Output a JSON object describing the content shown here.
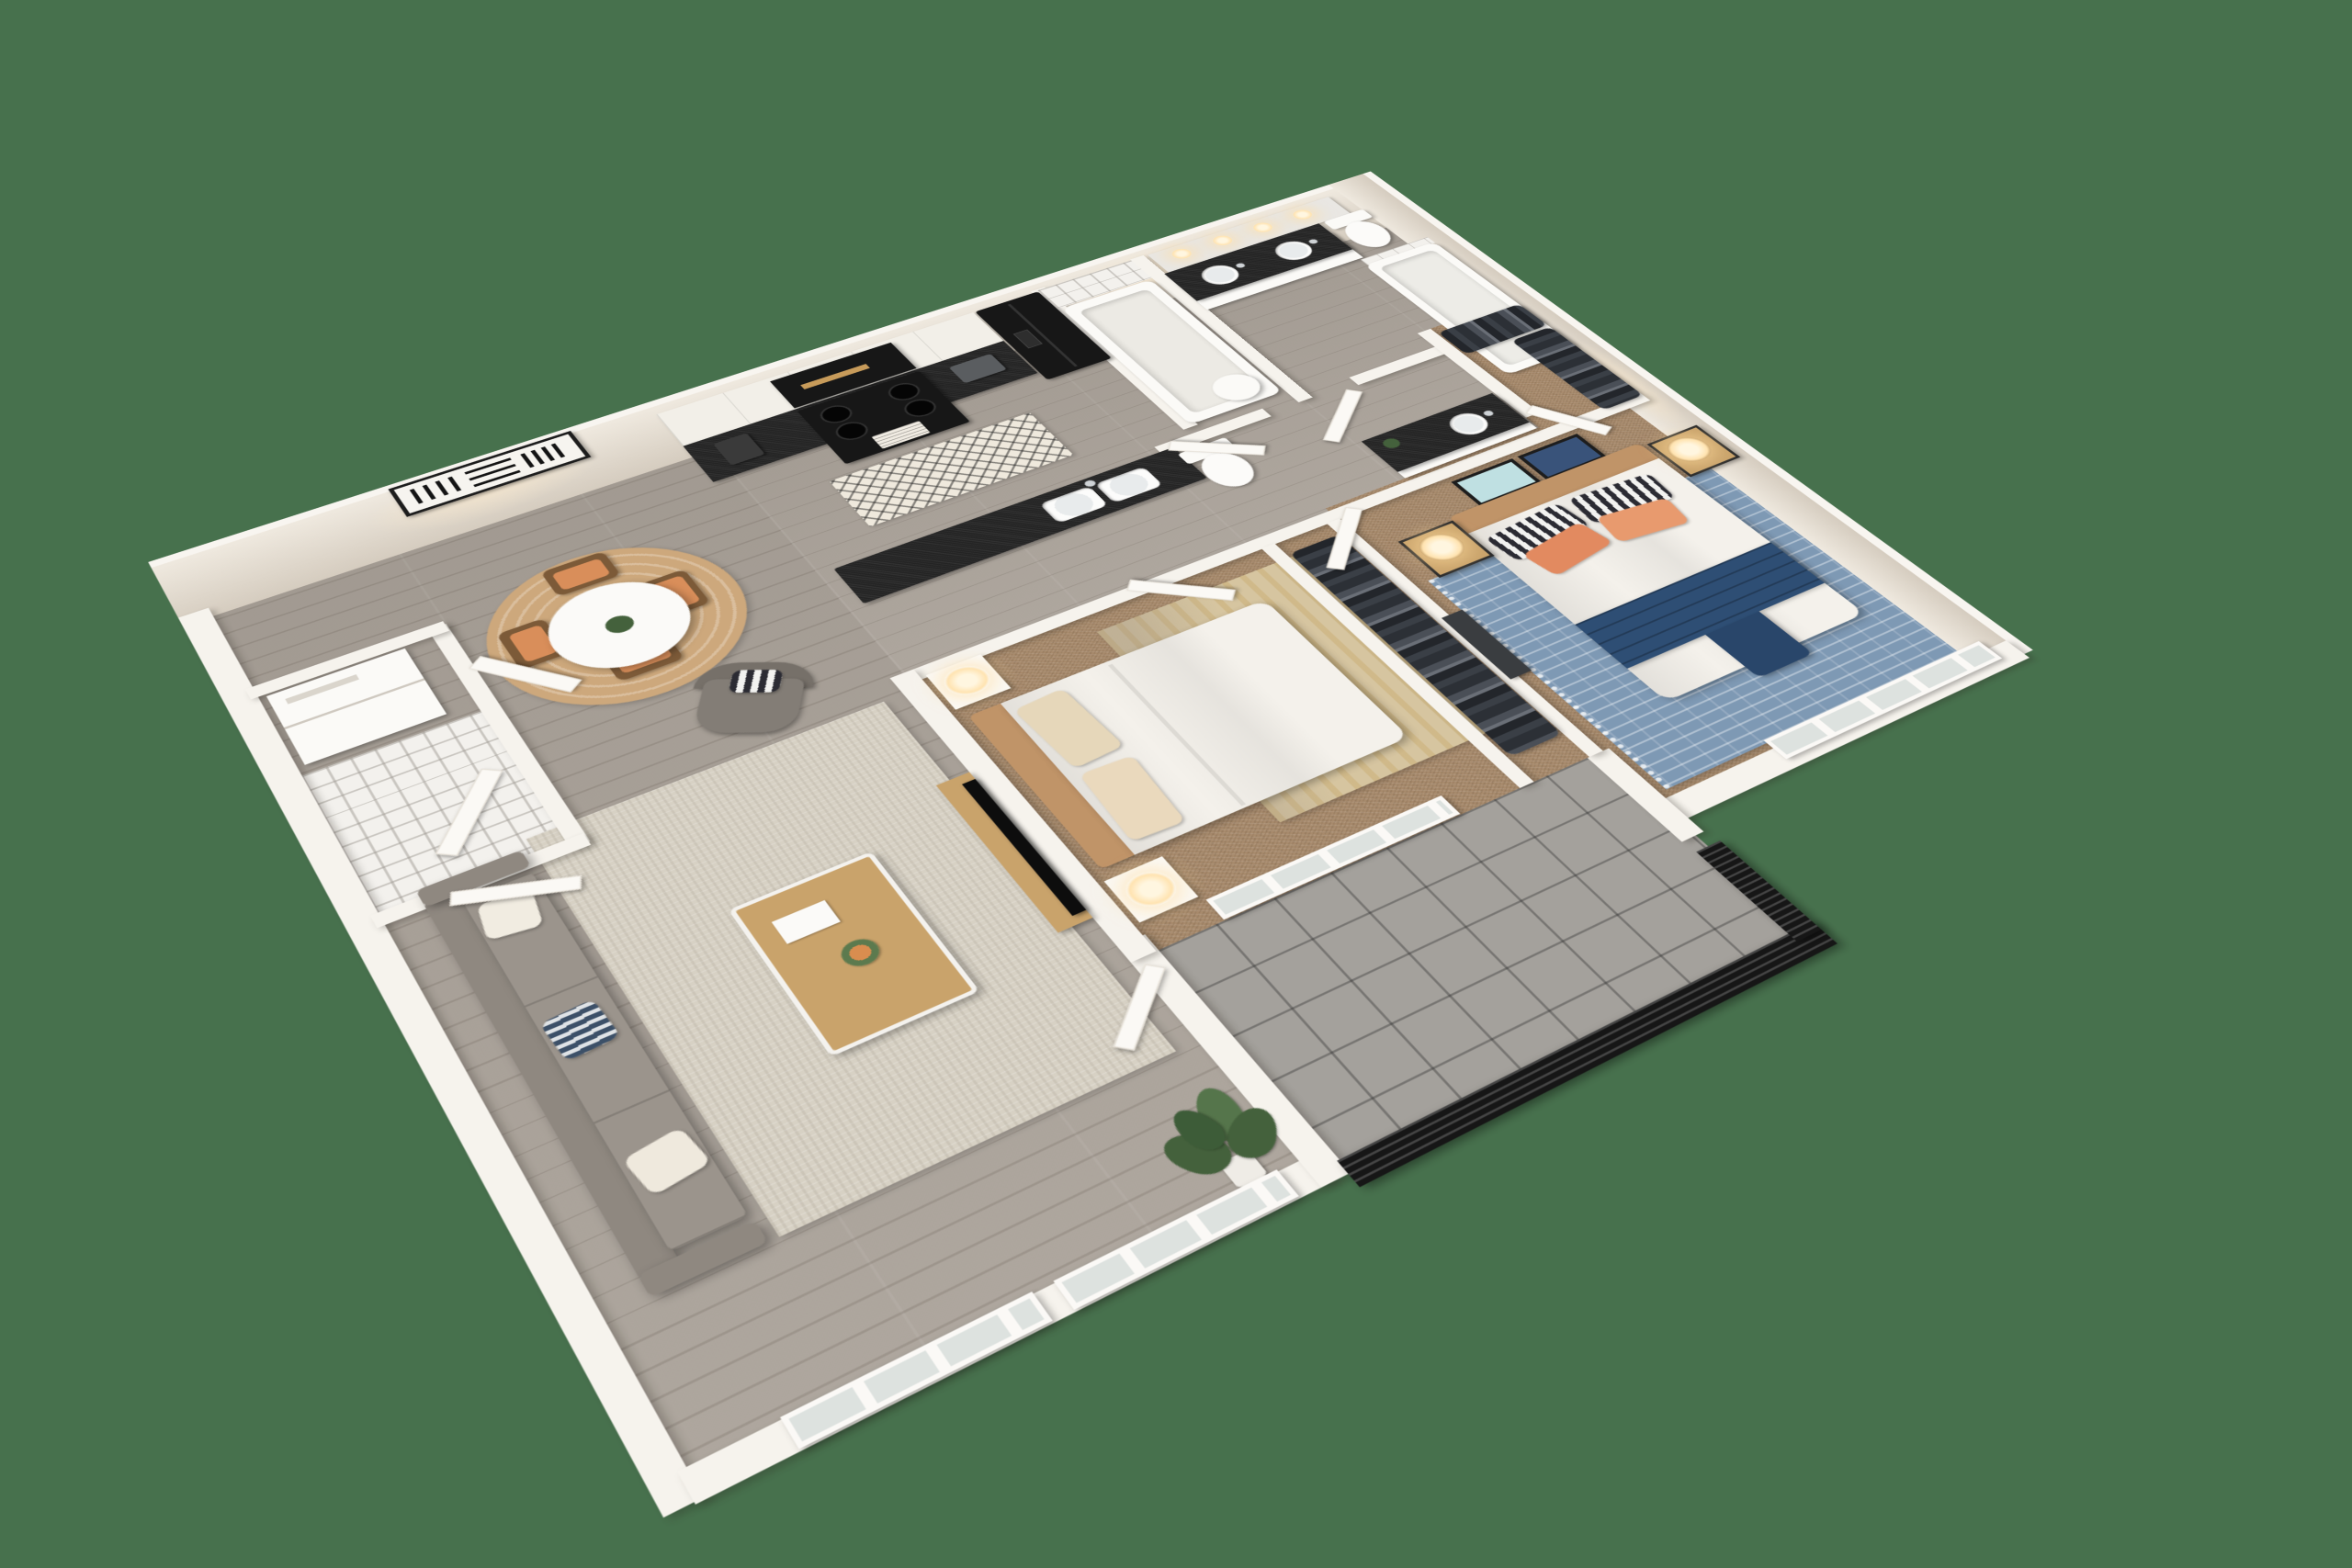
{
  "scene": {
    "type": "3d-floor-plan-render",
    "view": "isometric dollhouse, two-bedroom two-bath apartment",
    "background": "#47714d"
  },
  "palette": {
    "bg": "#47714d",
    "wall": "#f6f3ed",
    "wallCap": "#f8f5f0",
    "wallFaceLight": "#efe9df",
    "wallFaceDark": "#d5ccbf",
    "wood": "#a9a198",
    "carpet": "#a78a6c",
    "tileGray": "#a4a19c",
    "tileWhite": "#f3f1ed",
    "counter": "#242424",
    "appliance": "#171717",
    "cabinet": "#f2efe8",
    "sofa": "#8f8880",
    "rugBeige": "#d7d1c4",
    "rugBlue": "#7e99b4",
    "rugRound": "#cda87c",
    "rugGold": "#d6c5a0",
    "bedWhite": "#f4f1eb",
    "navy": "#2e4e74",
    "orange": "#e28a60",
    "headboardTan": "#c09468",
    "tableWood": "#c9a36b",
    "chairWood": "#7c5a38",
    "chairCushion": "#d98e5a",
    "plantGreen": "#44613c",
    "railing": "#161616",
    "glow": "#ffe3b0",
    "mirror": "#e9e7e3"
  },
  "rooms": [
    {
      "id": "living-room",
      "floor": "wood",
      "items": [
        "gray-sofa",
        "beige-area-rug",
        "wood-coffee-table",
        "accent-chair",
        "floor-plant",
        "tv-console",
        "windows"
      ]
    },
    {
      "id": "dining-area",
      "floor": "wood",
      "items": [
        "round-white-table",
        "four-wood-chairs",
        "round-jute-rug",
        "abstract-wall-art"
      ]
    },
    {
      "id": "kitchen",
      "floor": "wood",
      "items": [
        "white-upper-cabinets",
        "black-countertop",
        "black-microwave",
        "black-range",
        "black-fridge",
        "coffee-maker",
        "toaster",
        "island-with-double-sink",
        "patterned-runner-rug"
      ]
    },
    {
      "id": "entry",
      "floor": "tile",
      "items": [
        "stacked-laundry",
        "open-doors",
        "storage-closet"
      ]
    },
    {
      "id": "hall-bathroom",
      "floor": "wood",
      "items": [
        "tub-with-tile-surround",
        "toilet",
        "black-top-vanity",
        "laundry-basket"
      ]
    },
    {
      "id": "primary-bathroom",
      "floor": "wood",
      "items": [
        "double-sink-black-vanity",
        "mirror-with-lights",
        "toilet",
        "tub-with-white-tile"
      ]
    },
    {
      "id": "primary-closet",
      "floor": "carpet",
      "items": [
        "hanging-clothes"
      ]
    },
    {
      "id": "second-closet",
      "floor": "carpet",
      "items": [
        "hanging-clothes"
      ]
    },
    {
      "id": "bedroom-2",
      "floor": "carpet",
      "items": [
        "bed-cream-linens",
        "two-nightstands-with-lamps",
        "gold-gray-rug",
        "window-to-balcony"
      ]
    },
    {
      "id": "primary-bedroom",
      "floor": "carpet",
      "items": [
        "bed-white-duvet-navy-runner",
        "orange-and-striped-pillows",
        "two-framed-artworks",
        "two-nightstands-with-lamps",
        "blue-patterned-rug",
        "windows"
      ]
    },
    {
      "id": "balcony",
      "floor": "gray-tile",
      "items": [
        "black-slat-railing",
        "balcony-door"
      ]
    }
  ]
}
